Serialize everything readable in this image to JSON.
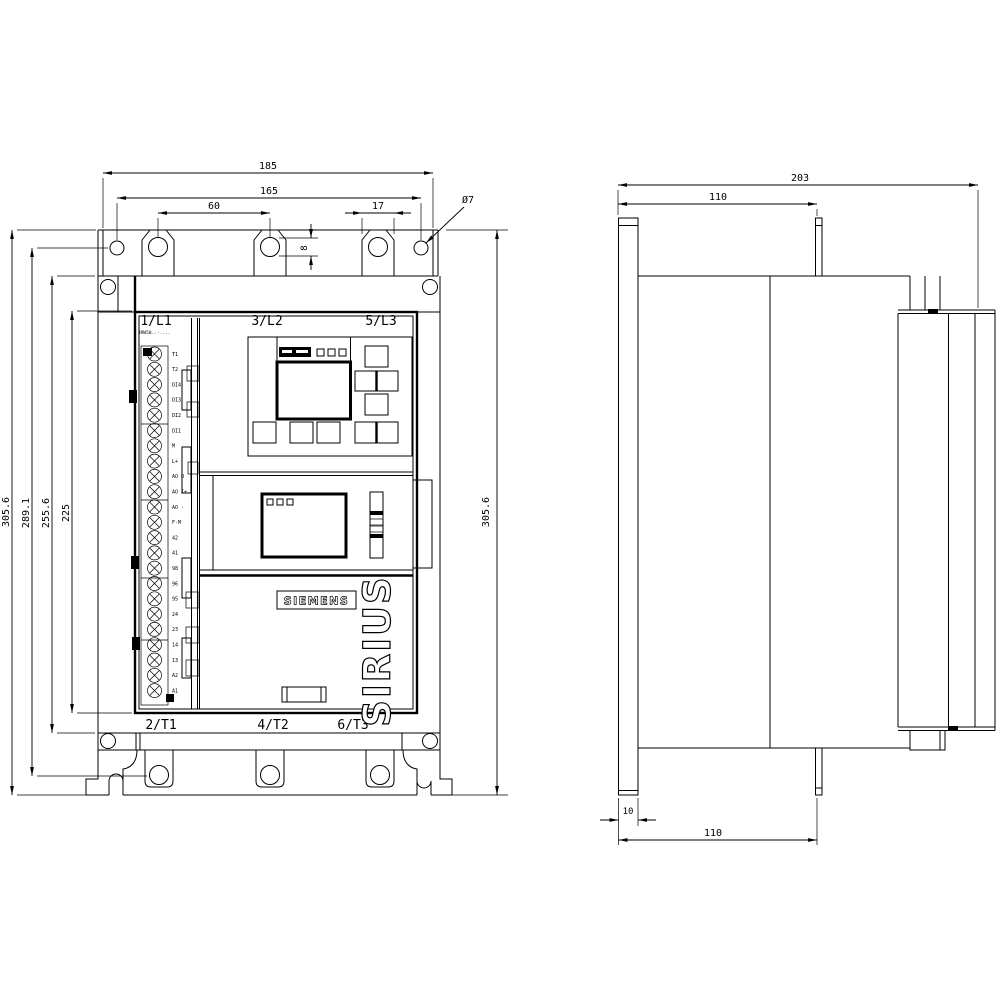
{
  "front_view": {
    "line_terminals_top": [
      "1/L1",
      "3/L2",
      "5/L3"
    ],
    "line_terminals_bottom": [
      "2/T1",
      "4/T2",
      "6/T3"
    ],
    "type_label": "3RW50..-....",
    "brand_label": "SIEMENS",
    "product_label": "SIRIUS",
    "control_terminal_labels": [
      "T1",
      "T2",
      "DI4",
      "DI3",
      "DI2",
      "DI1",
      "M",
      "L+",
      "AO U",
      "AO I+",
      "AO -",
      "F-M",
      "42",
      "41",
      "98",
      "96",
      "95",
      "24",
      "23",
      "14",
      "13",
      "A2",
      "A1"
    ],
    "dim_width_overall": "185",
    "dim_width_holes": "165",
    "dim_hole_pitch": "60",
    "dim_slot_width": "17",
    "dim_hole_dia": "Ø7",
    "dim_slot_height": "8",
    "dim_height_overall": "305.6",
    "dim_height_holes": "289.1",
    "dim_height_body": "255.6",
    "dim_height_inner": "225"
  },
  "side_view": {
    "dim_depth_overall": "203",
    "dim_depth_top": "110",
    "dim_flange": "10",
    "dim_depth_bottom": "110",
    "dim_height_overall": "305.6"
  }
}
